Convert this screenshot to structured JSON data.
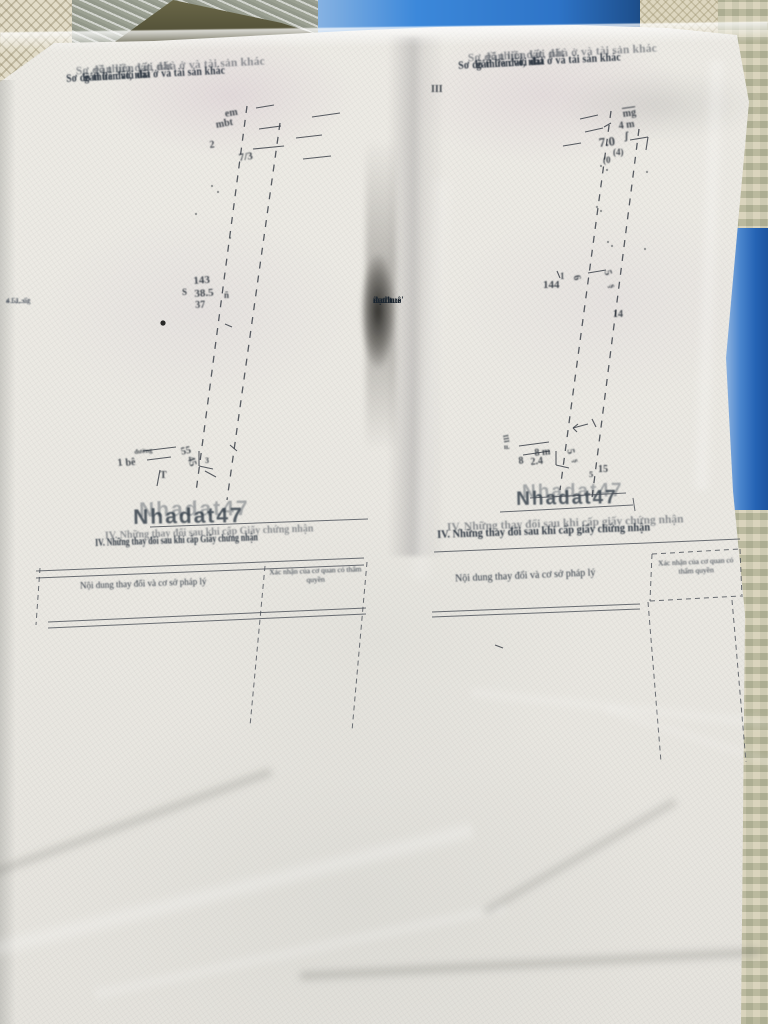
{
  "photo": {
    "watermark_text": "Nhadat47"
  },
  "left_page": {
    "header_line1": "Sơ đồ thửa đất, nhà ở và tài sản khác",
    "header_line2": "gắn liền với đất",
    "margin_note_lines": [
      "4.5, .:ốg",
      "· 1 ·, sử",
      "a ..à..",
      "– : 1"
    ],
    "section4_heading": "IV. Những thay đổi sau khi cấp Giấy chứng nhận",
    "table": {
      "col1_header": "Nội dung thay đổi và cơ sở pháp lý",
      "col2_header": "Xác nhận của cơ quan có thẩm quyền"
    },
    "diagram": {
      "labels": [
        {
          "t": "em",
          "x": 224,
          "y": 109,
          "r": -10,
          "s": 10
        },
        {
          "t": "mbt",
          "x": 215,
          "y": 120,
          "r": -10,
          "s": 10
        },
        {
          "t": "2",
          "x": 209,
          "y": 140,
          "r": -6,
          "s": 10
        },
        {
          "t": "7/3",
          "x": 238,
          "y": 152,
          "r": -8,
          "s": 11
        },
        {
          "t": "143",
          "x": 193,
          "y": 275,
          "r": -4,
          "s": 11
        },
        {
          "t": "38.5",
          "x": 194,
          "y": 288,
          "r": -4,
          "s": 11
        },
        {
          "t": "37",
          "x": 195,
          "y": 300,
          "r": -2,
          "s": 10
        },
        {
          "t": "S",
          "x": 182,
          "y": 287,
          "r": 0,
          "s": 9
        },
        {
          "t": "ñ",
          "x": 224,
          "y": 290,
          "r": 0,
          "s": 9
        },
        {
          "t": "55",
          "x": 180,
          "y": 447,
          "r": -12,
          "s": 10
        },
        {
          "t": "45",
          "x": 195,
          "y": 455,
          "r": 72,
          "s": 10
        },
        {
          "t": "3",
          "x": 205,
          "y": 456,
          "r": 0,
          "s": 8
        },
        {
          "t": "đường",
          "x": 134,
          "y": 449,
          "r": -6,
          "s": 6.5
        },
        {
          "t": "1",
          "x": 117,
          "y": 458,
          "r": -6,
          "s": 10
        },
        {
          "t": "bê",
          "x": 125,
          "y": 458,
          "r": -6,
          "s": 10
        },
        {
          "t": "T",
          "x": 160,
          "y": 470,
          "r": 0,
          "s": 10
        }
      ],
      "lines": [
        {
          "x1": 247,
          "y1": 106,
          "x2": 196,
          "y2": 492,
          "d": 1
        },
        {
          "x1": 280,
          "y1": 123,
          "x2": 227,
          "y2": 500,
          "d": 1
        },
        {
          "x1": 256,
          "y1": 108,
          "x2": 274,
          "y2": 105
        },
        {
          "x1": 259,
          "y1": 129,
          "x2": 281,
          "y2": 126
        },
        {
          "x1": 253,
          "y1": 149,
          "x2": 284,
          "y2": 146
        },
        {
          "x1": 296,
          "y1": 138,
          "x2": 322,
          "y2": 135
        },
        {
          "x1": 303,
          "y1": 159,
          "x2": 331,
          "y2": 156
        },
        {
          "x1": 312,
          "y1": 117,
          "x2": 340,
          "y2": 113
        },
        {
          "x1": 143,
          "y1": 451,
          "x2": 176,
          "y2": 447
        },
        {
          "x1": 147,
          "y1": 460,
          "x2": 171,
          "y2": 457
        },
        {
          "x1": 199,
          "y1": 451,
          "x2": 199,
          "y2": 466
        },
        {
          "x1": 199,
          "y1": 466,
          "x2": 213,
          "y2": 469
        },
        {
          "x1": 230,
          "y1": 445,
          "x2": 237,
          "y2": 451
        },
        {
          "x1": 160,
          "y1": 470,
          "x2": 157,
          "y2": 486
        },
        {
          "x1": 205,
          "y1": 471,
          "x2": 216,
          "y2": 477
        },
        {
          "x1": 225,
          "y1": 324,
          "x2": 232,
          "y2": 327
        }
      ],
      "rules": [
        {
          "x1": 150,
          "y1": 527,
          "x2": 368,
          "y2": 519
        },
        {
          "x1": 36,
          "y1": 571,
          "x2": 364,
          "y2": 558
        },
        {
          "x1": 36,
          "y1": 578,
          "x2": 364,
          "y2": 565
        },
        {
          "x1": 48,
          "y1": 622,
          "x2": 366,
          "y2": 608
        },
        {
          "x1": 48,
          "y1": 628,
          "x2": 366,
          "y2": 614
        },
        {
          "x1": 265,
          "y1": 566,
          "x2": 250,
          "y2": 726,
          "d": 1
        },
        {
          "x1": 367,
          "y1": 562,
          "x2": 352,
          "y2": 731,
          "d": 1
        },
        {
          "x1": 40,
          "y1": 568,
          "x2": 36,
          "y2": 625,
          "d": 1
        }
      ],
      "dots": [
        {
          "x": 163,
          "y": 323,
          "r": 2.6,
          "k": 1
        },
        {
          "x": 212,
          "y": 186
        },
        {
          "x": 218,
          "y": 192
        },
        {
          "x": 196,
          "y": 214
        },
        {
          "x": 230,
          "y": 238
        }
      ]
    }
  },
  "right_page": {
    "header_line1": "Sơ đồ thửa đất, nhà ở và tài sản khác",
    "header_line2": "gắn liền với đất",
    "edge_text_lines": [
      "đao tuê'",
      "ít chu·s",
      "«u đnu",
      "nạt n"
    ],
    "section4_heading": "IV. Những thay đổi sau khi cấp giấy chứng nhận",
    "table": {
      "col1_header": "Nội dung thay đổi và cơ sở pháp lý",
      "col2_header": "Xác nhận của cơ quan có thẩm quyền"
    },
    "diagram": {
      "labels": [
        {
          "t": "III",
          "x": 431,
          "y": 84,
          "r": 0,
          "s": 10
        },
        {
          "t": "mg",
          "x": 622,
          "y": 109,
          "r": -8,
          "s": 10,
          "u": 1
        },
        {
          "t": "4 m",
          "x": 618,
          "y": 121,
          "r": -8,
          "s": 10
        },
        {
          "t": "ʃ",
          "x": 625,
          "y": 131,
          "r": 0,
          "s": 10
        },
        {
          "t": "7.0",
          "x": 598,
          "y": 135,
          "r": -6,
          "s": 13
        },
        {
          "t": "(4)",
          "x": 613,
          "y": 147,
          "r": 0,
          "s": 9
        },
        {
          "t": "(0",
          "x": 603,
          "y": 155,
          "r": 0,
          "s": 9
        },
        {
          "t": "144",
          "x": 543,
          "y": 279,
          "r": 0,
          "s": 11
        },
        {
          "t": "6",
          "x": 581,
          "y": 274,
          "r": 75,
          "s": 10
        },
        {
          "t": "1",
          "x": 560,
          "y": 271,
          "r": 0,
          "s": 9
        },
        {
          "t": "5",
          "x": 612,
          "y": 269,
          "r": 75,
          "s": 10
        },
        {
          "t": "ş",
          "x": 617,
          "y": 283,
          "r": 75,
          "s": 9
        },
        {
          "t": "14",
          "x": 613,
          "y": 309,
          "r": 0,
          "s": 10
        },
        {
          "t": "8 m",
          "x": 534,
          "y": 448,
          "r": -6,
          "s": 10
        },
        {
          "t": "8",
          "x": 518,
          "y": 456,
          "r": -6,
          "s": 10
        },
        {
          "t": "2.4",
          "x": 530,
          "y": 457,
          "r": -6,
          "s": 10
        },
        {
          "t": "5",
          "x": 575,
          "y": 448,
          "r": 78,
          "s": 10
        },
        {
          "t": "ş",
          "x": 581,
          "y": 458,
          "r": 78,
          "s": 8.5
        },
        {
          "t": "15",
          "x": 598,
          "y": 464,
          "r": 0,
          "s": 10
        },
        {
          "t": "5",
          "x": 589,
          "y": 469,
          "r": 0,
          "s": 8.5
        },
        {
          "t": "III",
          "x": 509,
          "y": 434,
          "r": 80,
          "s": 7
        },
        {
          "t": "ıı.",
          "x": 504,
          "y": 443,
          "r": 0,
          "s": 7
        }
      ],
      "lines": [
        {
          "x1": 611,
          "y1": 111,
          "x2": 560,
          "y2": 490,
          "d": 1
        },
        {
          "x1": 639,
          "y1": 129,
          "x2": 592,
          "y2": 498,
          "d": 1
        },
        {
          "x1": 580,
          "y1": 119,
          "x2": 598,
          "y2": 115
        },
        {
          "x1": 585,
          "y1": 132,
          "x2": 603,
          "y2": 128
        },
        {
          "x1": 563,
          "y1": 146,
          "x2": 581,
          "y2": 143
        },
        {
          "x1": 630,
          "y1": 140,
          "x2": 648,
          "y2": 137
        },
        {
          "x1": 648,
          "y1": 137,
          "x2": 646,
          "y2": 150
        },
        {
          "x1": 604,
          "y1": 127,
          "x2": 611,
          "y2": 123
        },
        {
          "x1": 588,
          "y1": 273,
          "x2": 606,
          "y2": 270
        },
        {
          "x1": 557,
          "y1": 271,
          "x2": 560,
          "y2": 278
        },
        {
          "x1": 519,
          "y1": 446,
          "x2": 549,
          "y2": 442
        },
        {
          "x1": 523,
          "y1": 455,
          "x2": 550,
          "y2": 451
        },
        {
          "x1": 556,
          "y1": 451,
          "x2": 556,
          "y2": 465
        },
        {
          "x1": 556,
          "y1": 465,
          "x2": 569,
          "y2": 468
        },
        {
          "x1": 573,
          "y1": 428,
          "x2": 588,
          "y2": 424
        },
        {
          "x1": 573,
          "y1": 428,
          "x2": 578,
          "y2": 424
        },
        {
          "x1": 573,
          "y1": 428,
          "x2": 577,
          "y2": 432
        },
        {
          "x1": 592,
          "y1": 419,
          "x2": 596,
          "y2": 427
        },
        {
          "x1": 495,
          "y1": 645,
          "x2": 503,
          "y2": 648
        }
      ],
      "rules": [
        {
          "x1": 530,
          "y1": 498,
          "x2": 626,
          "y2": 493
        },
        {
          "x1": 500,
          "y1": 512,
          "x2": 633,
          "y2": 505
        },
        {
          "x1": 633,
          "y1": 498,
          "x2": 635,
          "y2": 511
        },
        {
          "x1": 434,
          "y1": 552,
          "x2": 740,
          "y2": 539
        },
        {
          "x1": 432,
          "y1": 612,
          "x2": 640,
          "y2": 604
        },
        {
          "x1": 432,
          "y1": 617,
          "x2": 640,
          "y2": 609
        },
        {
          "x1": 652,
          "y1": 554,
          "x2": 740,
          "y2": 549,
          "d": 1
        },
        {
          "x1": 650,
          "y1": 601,
          "x2": 741,
          "y2": 596,
          "d": 1
        },
        {
          "x1": 652,
          "y1": 554,
          "x2": 650,
          "y2": 601,
          "d": 1
        },
        {
          "x1": 740,
          "y1": 549,
          "x2": 742,
          "y2": 597,
          "d": 1
        },
        {
          "x1": 648,
          "y1": 602,
          "x2": 661,
          "y2": 762,
          "d": 1
        },
        {
          "x1": 732,
          "y1": 600,
          "x2": 746,
          "y2": 762,
          "d": 1
        }
      ],
      "dots": [
        {
          "x": 601,
          "y": 166
        },
        {
          "x": 607,
          "y": 170
        },
        {
          "x": 647,
          "y": 172
        },
        {
          "x": 597,
          "y": 207
        },
        {
          "x": 601,
          "y": 211
        },
        {
          "x": 608,
          "y": 242
        },
        {
          "x": 612,
          "y": 246
        },
        {
          "x": 645,
          "y": 249
        }
      ]
    }
  }
}
